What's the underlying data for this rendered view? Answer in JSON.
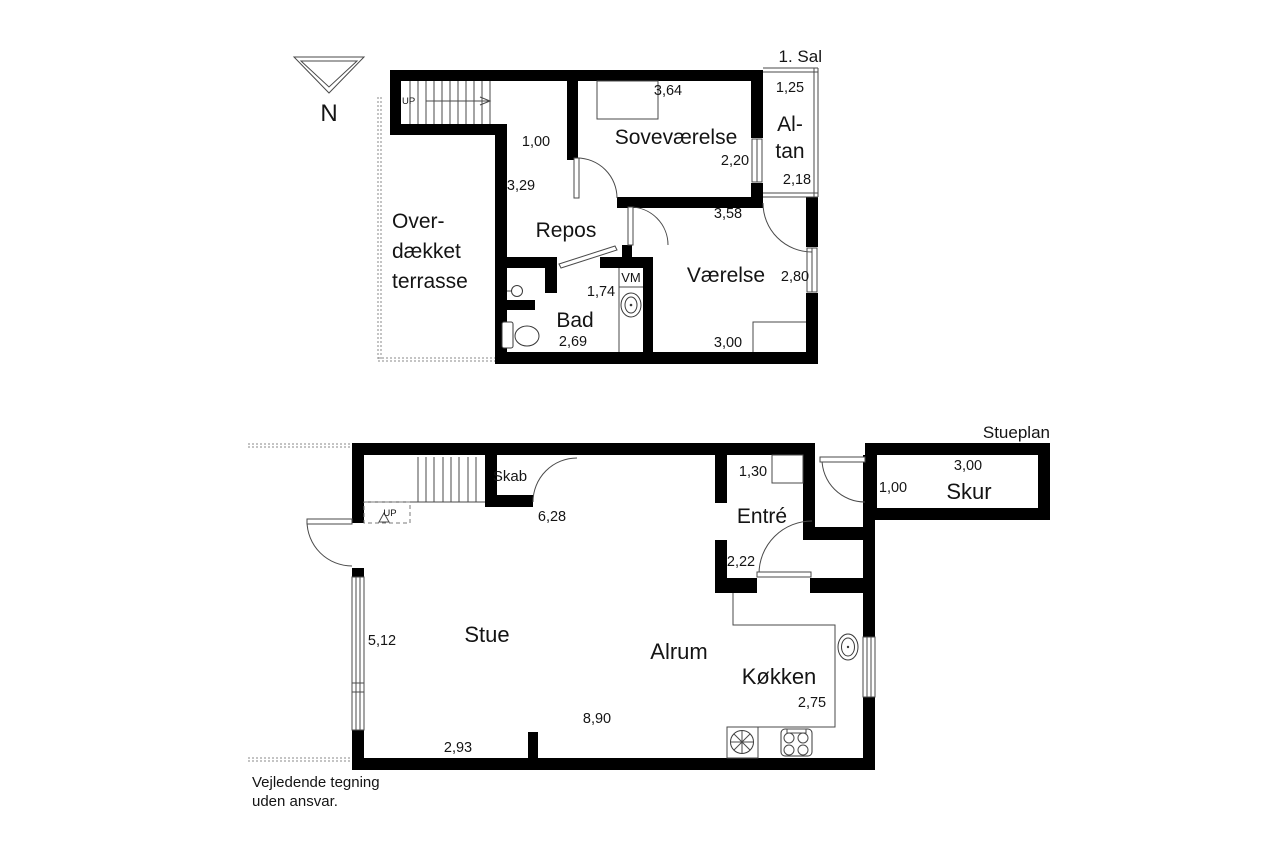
{
  "colors": {
    "wall": "#000000",
    "line": "#4a4a4a",
    "background": "#ffffff"
  },
  "north": {
    "label": "N"
  },
  "disclaimer": {
    "line1": "Vejledende tegning",
    "line2": "uden ansvar."
  },
  "upper_floor": {
    "title": "1. Sal",
    "stairs_label": "UP",
    "rooms": {
      "terrace": {
        "line1": "Over-",
        "line2": "dækket",
        "line3": "terrasse"
      },
      "hall": {
        "width": "1,00",
        "length": "3,29"
      },
      "repos": {
        "name": "Repos"
      },
      "sovevaerelse": {
        "name": "Soveværelse",
        "width": "3,64",
        "depth": "2,20"
      },
      "altan": {
        "name_line1": "Al-",
        "name_line2": "tan",
        "width": "1,25",
        "depth": "2,18"
      },
      "vaerelse": {
        "name": "Værelse",
        "width_top": "3,58",
        "depth": "2,80",
        "width_bottom": "3,00"
      },
      "bad": {
        "name": "Bad",
        "width": "2,69",
        "inner": "1,74"
      },
      "vm": {
        "name": "VM"
      }
    }
  },
  "ground_floor": {
    "title": "Stueplan",
    "stairs_label": "UP",
    "rooms": {
      "skab": {
        "name": "Skab",
        "width": "6,28"
      },
      "stue": {
        "name": "Stue",
        "window": "5,12",
        "width": "2,93"
      },
      "alrum": {
        "name": "Alrum",
        "length": "8,90"
      },
      "koekken": {
        "name": "Køkken",
        "depth": "2,75"
      },
      "entre": {
        "name": "Entré",
        "width": "1,30",
        "depth": "2,22"
      },
      "skur": {
        "name": "Skur",
        "width": "3,00",
        "depth": "1,00"
      }
    }
  }
}
